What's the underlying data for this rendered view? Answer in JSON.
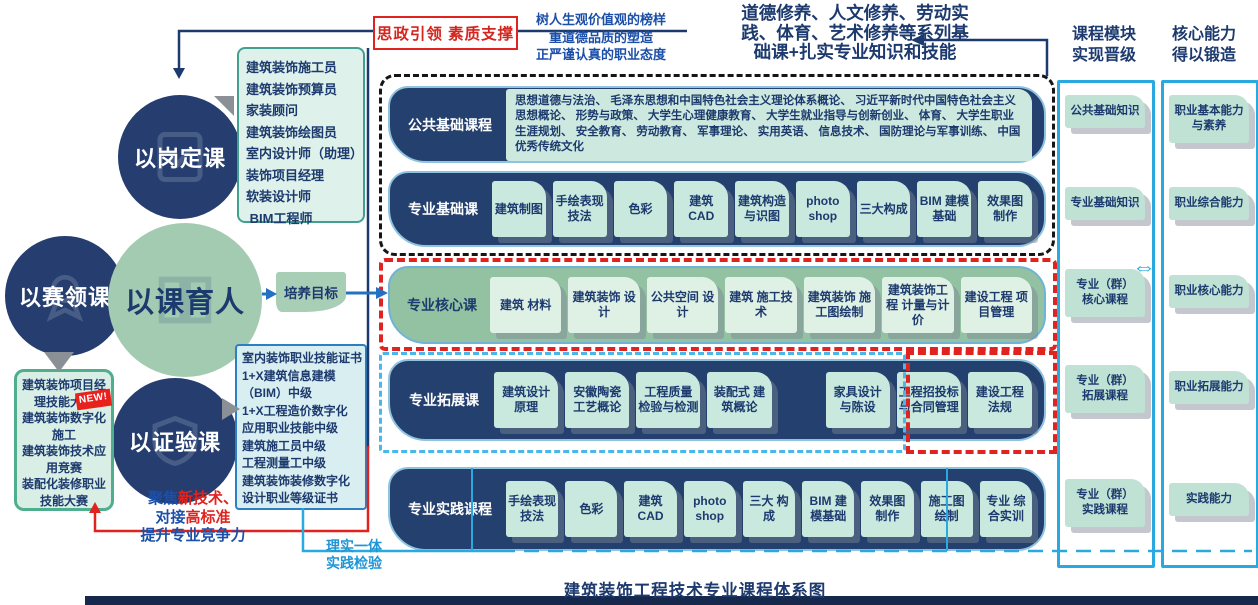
{
  "colors": {
    "navy": "#1d3a6e",
    "row_navy": "#24406e",
    "green_row": "#93c2a3",
    "green_circle": "#a3cbb1",
    "chip_teal": "#c9e8de",
    "cyan": "#2aa9e0",
    "red": "#e0231f",
    "blue_text": "#1b4fa8"
  },
  "top": {
    "red_box_label": "思政引领 素质支撑",
    "values_text": "树人生观价值观的榜样\n重道德品质的塑造\n正严谨认真的职业态度",
    "foundation_text": "道德修养、人文修养、劳动实\n践、体育、艺术修养等系列基\n础课+扎实专业知识和技能"
  },
  "circles": {
    "post": "以岗定课",
    "competition": "以赛领课",
    "center": "以课育人",
    "certificate": "以证验课"
  },
  "jobs_box_text": "建筑装饰施工员\n建筑装饰预算员\n家装顾问\n建筑装饰绘图员\n室内设计师（助理）\n装饰项目经理\n软装设计师\n BIM工程师",
  "cert_box_text": "室内装饰职业技能证书\n1+X建筑信息建模\n（BIM）中级\n1+X工程造价数字化\n应用职业技能中级\n建筑施工员中级\n工程测量工中级\n建筑装饰装修数字化\n设计职业等级证书",
  "competition_box": {
    "items": [
      {
        "text": "建筑装饰项目经理技能大赛",
        "badge": "NEW!"
      },
      {
        "text": "建筑装饰数字化施工"
      },
      {
        "text": "建筑装饰技术应用竞赛"
      },
      {
        "text": "装配化装修职业技能大赛"
      }
    ]
  },
  "focus_lines": [
    [
      {
        "t": "聚焦",
        "c": "blue"
      },
      {
        "t": "新技术",
        "c": "red"
      },
      {
        "t": "、",
        "c": "red"
      }
    ],
    [
      {
        "t": "对接",
        "c": "blue"
      },
      {
        "t": "高标准",
        "c": "red"
      }
    ],
    [
      {
        "t": "提升专业竞争力",
        "c": "blue"
      }
    ]
  ],
  "training_goal_label": "培养目标",
  "practice_note": "理实一体\n实践检验",
  "rows": {
    "public_basic": {
      "label": "公共基础课程",
      "content": "思想道德与法治、 毛泽东思想和中国特色社会主义理论体系概论、 习近平新时代中国特色社会主义思想概论、 形势与政策、 大学生心理健康教育、 大学生就业指导与创新创业、 体育、 大学生职业生涯规划、 安全教育、 劳动教育、 军事理论、 实用英语、 信息技术、 国防理论与军事训练、 中国优秀传统文化"
    },
    "pro_basic": {
      "label": "专业基础课",
      "chips": [
        "建筑制图",
        "手绘表现 技法",
        "色彩",
        "建筑 CAD",
        "建筑构造 与识图",
        "photo shop",
        "三大构成",
        "BIM 建模 基础",
        "效果图 制作"
      ]
    },
    "pro_core": {
      "label": "专业核心课",
      "chips": [
        "建筑 材料",
        "建筑装饰 设计",
        "公共空间 设计",
        "建筑 施工技术",
        "建筑装饰 施工图绘制",
        "建筑装饰工程 计量与计价",
        "建设工程 项目管理"
      ]
    },
    "pro_extend": {
      "label": "专业拓展课",
      "chips": [
        "建筑设计 原理",
        "安徽陶瓷 工艺概论",
        "工程质量 检验与检测",
        "装配式 建筑概论",
        {
          "gap": true
        },
        "家具设计 与陈设",
        "工程招投标 与合同管理",
        "建设工程 法规"
      ]
    },
    "pro_practice": {
      "label": "专业实践课程",
      "chips": [
        "手绘表现 技法",
        "色彩",
        "建筑 CAD",
        "photo shop",
        "三大 构成",
        "BIM 建模基础",
        "效果图 制作",
        "施工图 绘制",
        "专业 综合实训"
      ]
    }
  },
  "right_columns": [
    {
      "header": "课程模块\n实现晋级",
      "items": [
        "公共基础知识",
        "专业基础知识",
        "专业（群）\n核心课程",
        "专业（群）\n拓展课程",
        "专业（群）\n实践课程"
      ]
    },
    {
      "header": "核心能力\n得以锻造",
      "items": [
        "职业基本能力\n与素养",
        "职业综合能力",
        "职业核心能力",
        "职业拓展能力",
        "实践能力"
      ]
    }
  ],
  "swap_icon": "⇔",
  "caption": "建筑装饰工程技术专业课程体系图"
}
